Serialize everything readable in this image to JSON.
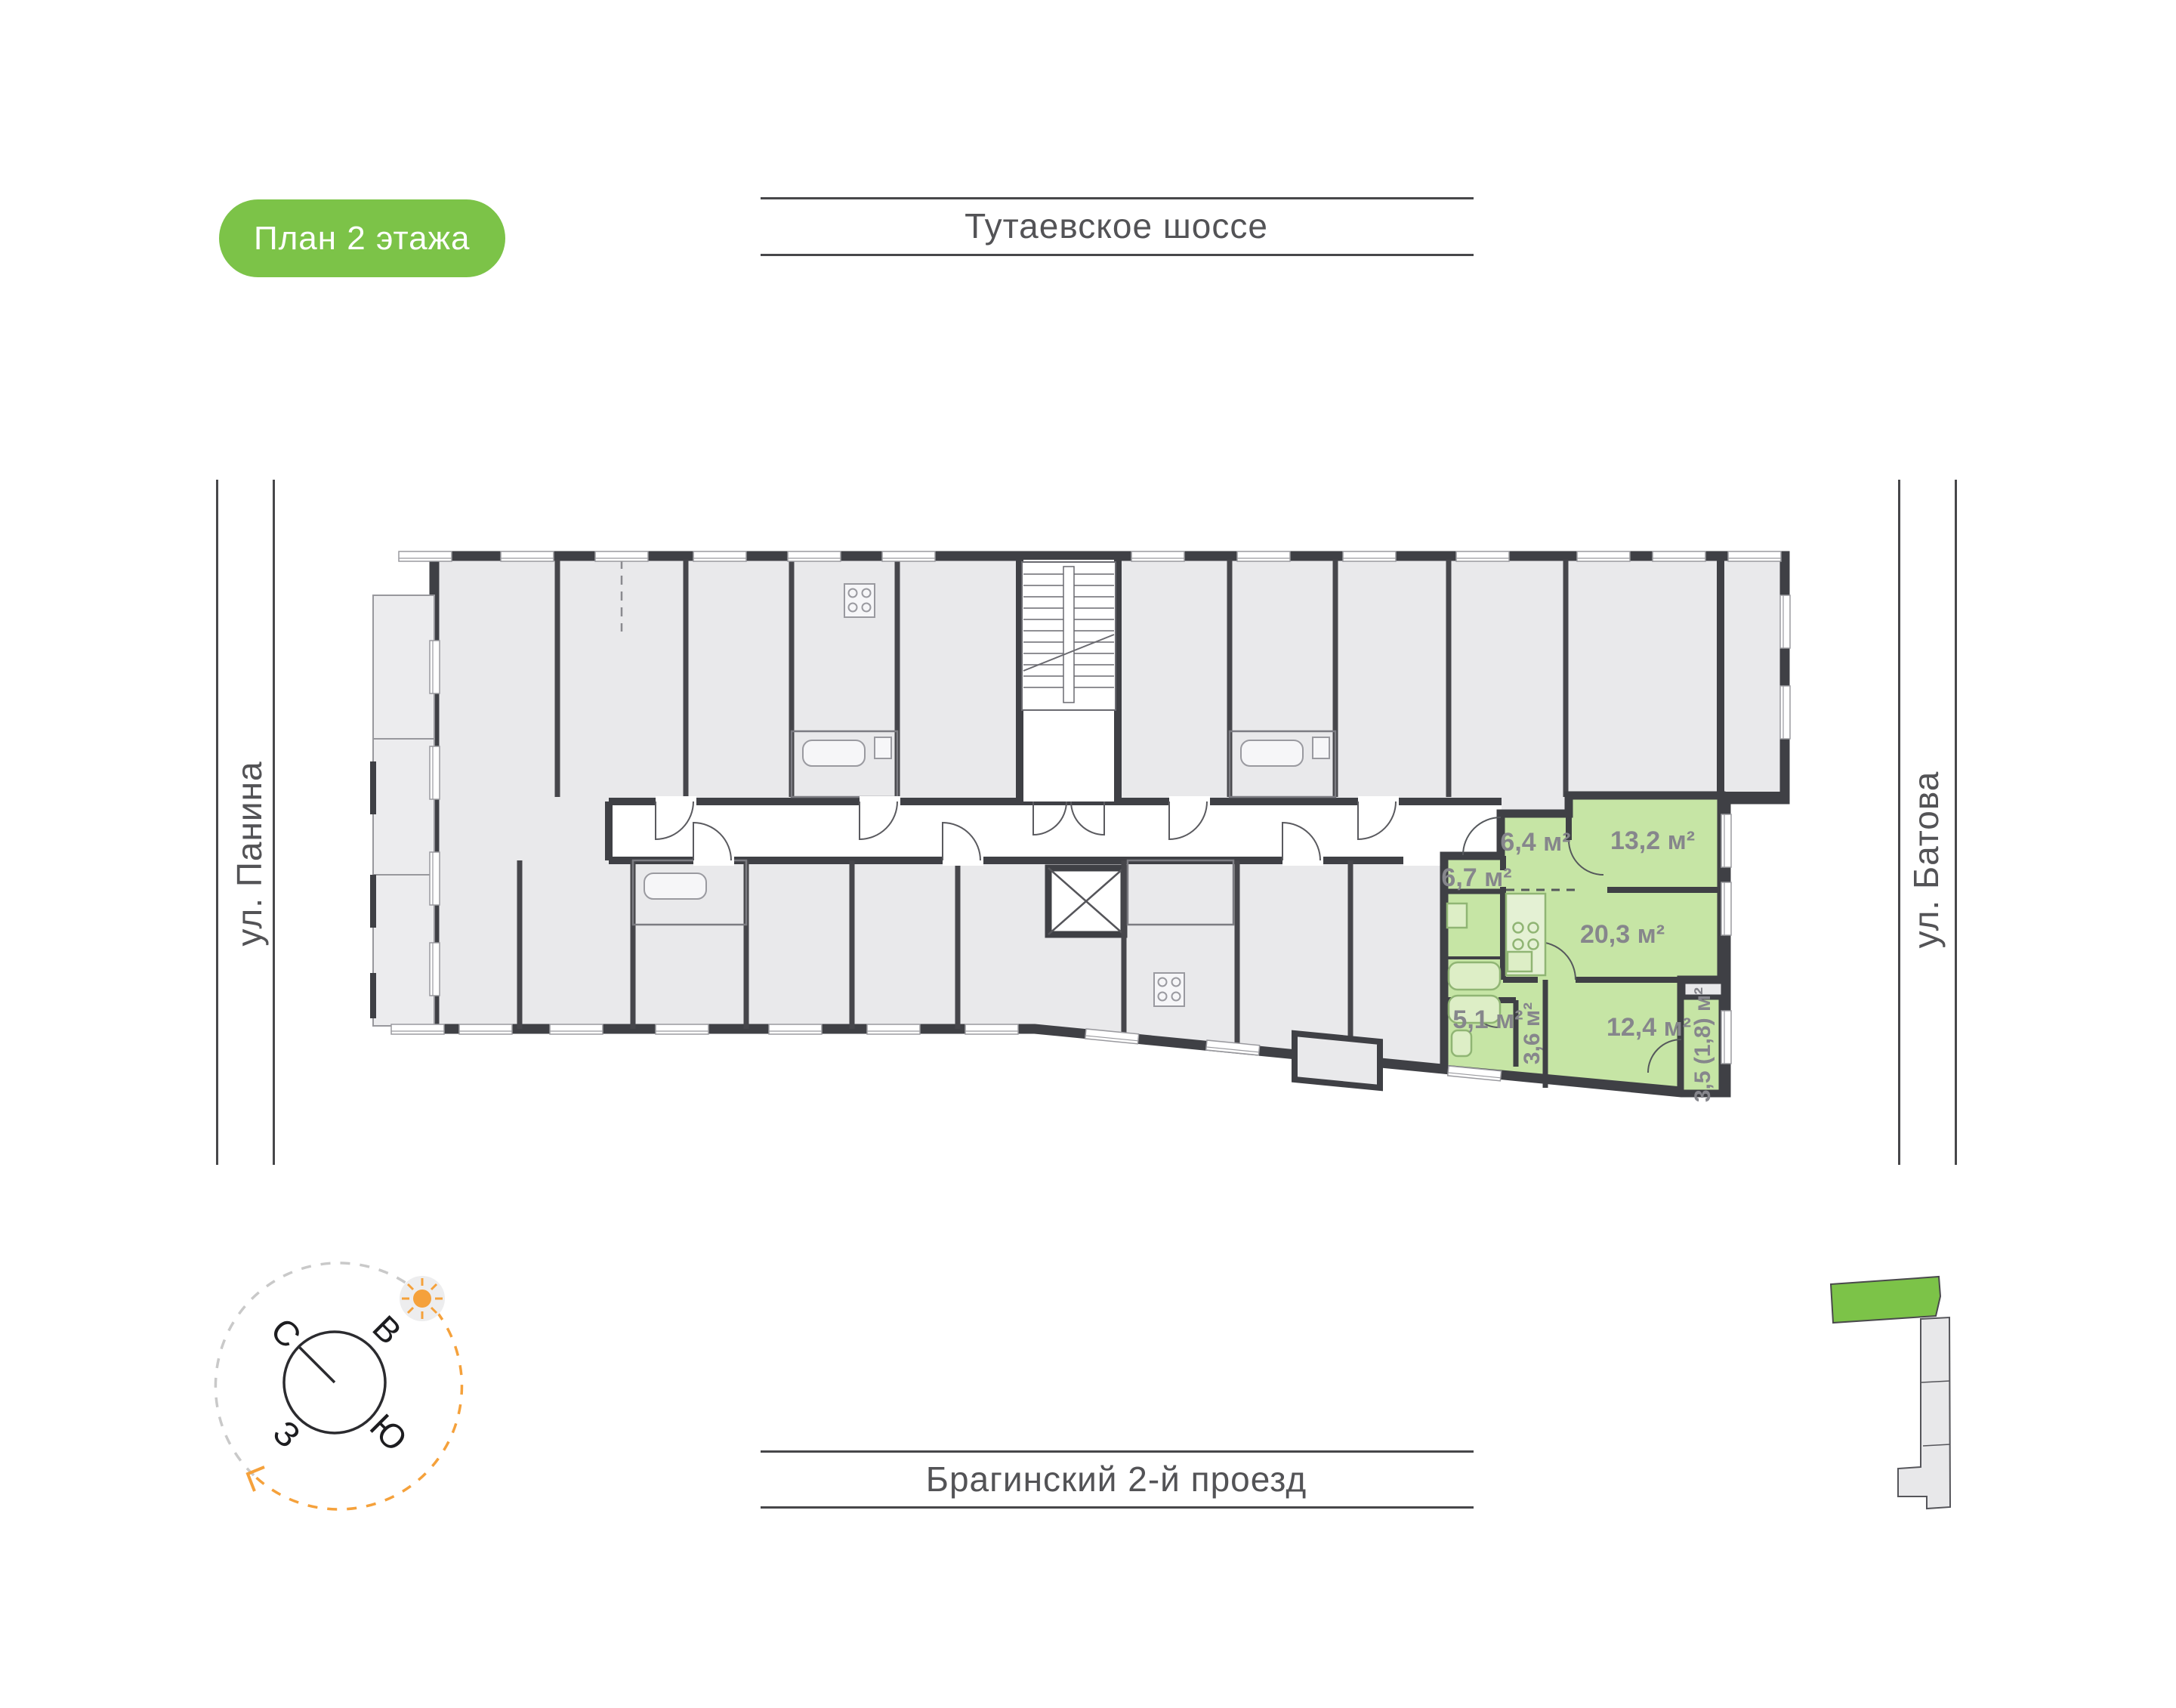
{
  "title_badge": {
    "label": "План 2 этажа"
  },
  "streets": {
    "top": "Тутаевское шоссе",
    "bottom": "Брагинский 2-й проезд",
    "left": "ул. Панина",
    "right": "ул. Батова"
  },
  "apartment": {
    "rooms": [
      {
        "name": "hallway",
        "area": "6,4 м²"
      },
      {
        "name": "bedroom",
        "area": "13,2 м²"
      },
      {
        "name": "entry-hall",
        "area": "6,7 м²"
      },
      {
        "name": "kitchen-living-room",
        "area": "20,3 м²"
      },
      {
        "name": "bathroom",
        "area": "5,1 м²"
      },
      {
        "name": "corridor",
        "area": "3,6 м²"
      },
      {
        "name": "bedroom-2",
        "area": "12,4 м²"
      },
      {
        "name": "balcony",
        "area": "3,5 (1,8) м²"
      }
    ]
  },
  "compass": {
    "north": "С",
    "east": "В",
    "south": "Ю",
    "west": "З"
  },
  "colors": {
    "accent_green": "#7cc348",
    "apartment_fill": "#c6e5a5",
    "wall_dark": "#3f4045",
    "room_gray": "#e9e9eb",
    "sun_orange": "#f5a13b",
    "label_gray": "#86868c",
    "street_gray": "#535356"
  }
}
